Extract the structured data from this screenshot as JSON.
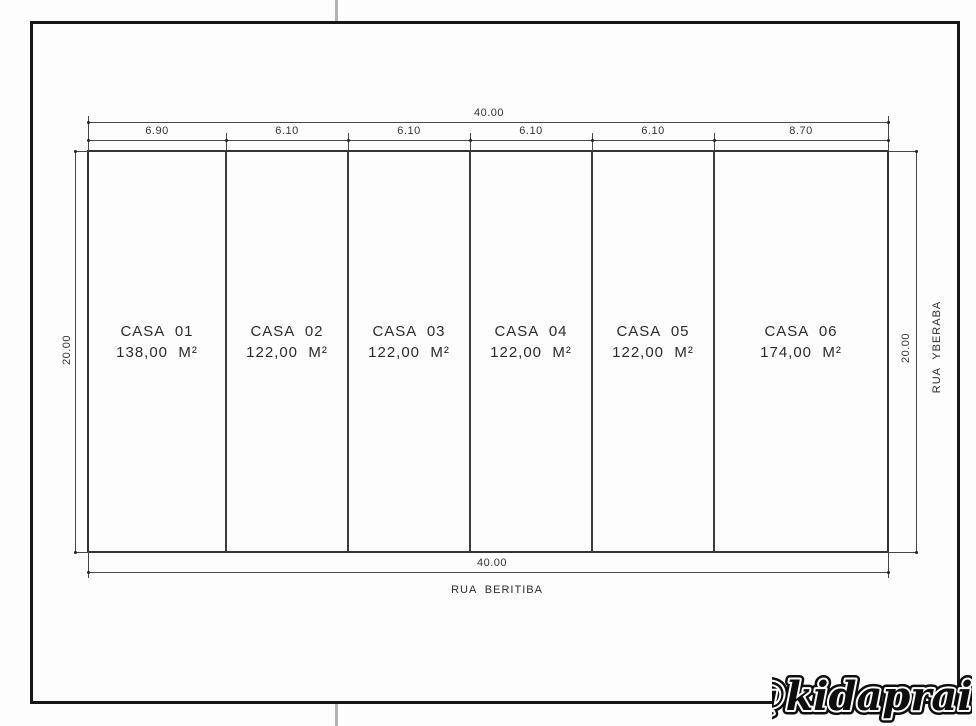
{
  "drawing": {
    "title_hint": "site plan of six house lots",
    "scale_px_per_m": 20,
    "top_total_dim": "40.00",
    "bottom_total_dim": "40.00",
    "left_dim": "20.00",
    "right_dim": "20.00",
    "street_bottom": "RUA  BERITIBA",
    "street_right": "RUA  YBERABA",
    "segments": [
      "6.90",
      "6.10",
      "6.10",
      "6.10",
      "6.10",
      "8.70"
    ],
    "segment_meters": [
      6.9,
      6.1,
      6.1,
      6.1,
      6.1,
      8.7
    ],
    "lots": [
      {
        "name": "CASA  01",
        "area": "138,00  M²"
      },
      {
        "name": "CASA  02",
        "area": "122,00  M²"
      },
      {
        "name": "CASA  03",
        "area": "122,00  M²"
      },
      {
        "name": "CASA  04",
        "area": "122,00  M²"
      },
      {
        "name": "CASA  05",
        "area": "122,00  M²"
      },
      {
        "name": "CASA  06",
        "area": "174,00  M²"
      }
    ]
  },
  "watermark": {
    "text": "@kidapraia"
  },
  "colors": {
    "frame": "#161616",
    "line": "#474747",
    "lot_border": "#343434",
    "text": "#2e2e2e",
    "registration_tick": "#b3b3b3",
    "background": "#fdfdfd"
  }
}
